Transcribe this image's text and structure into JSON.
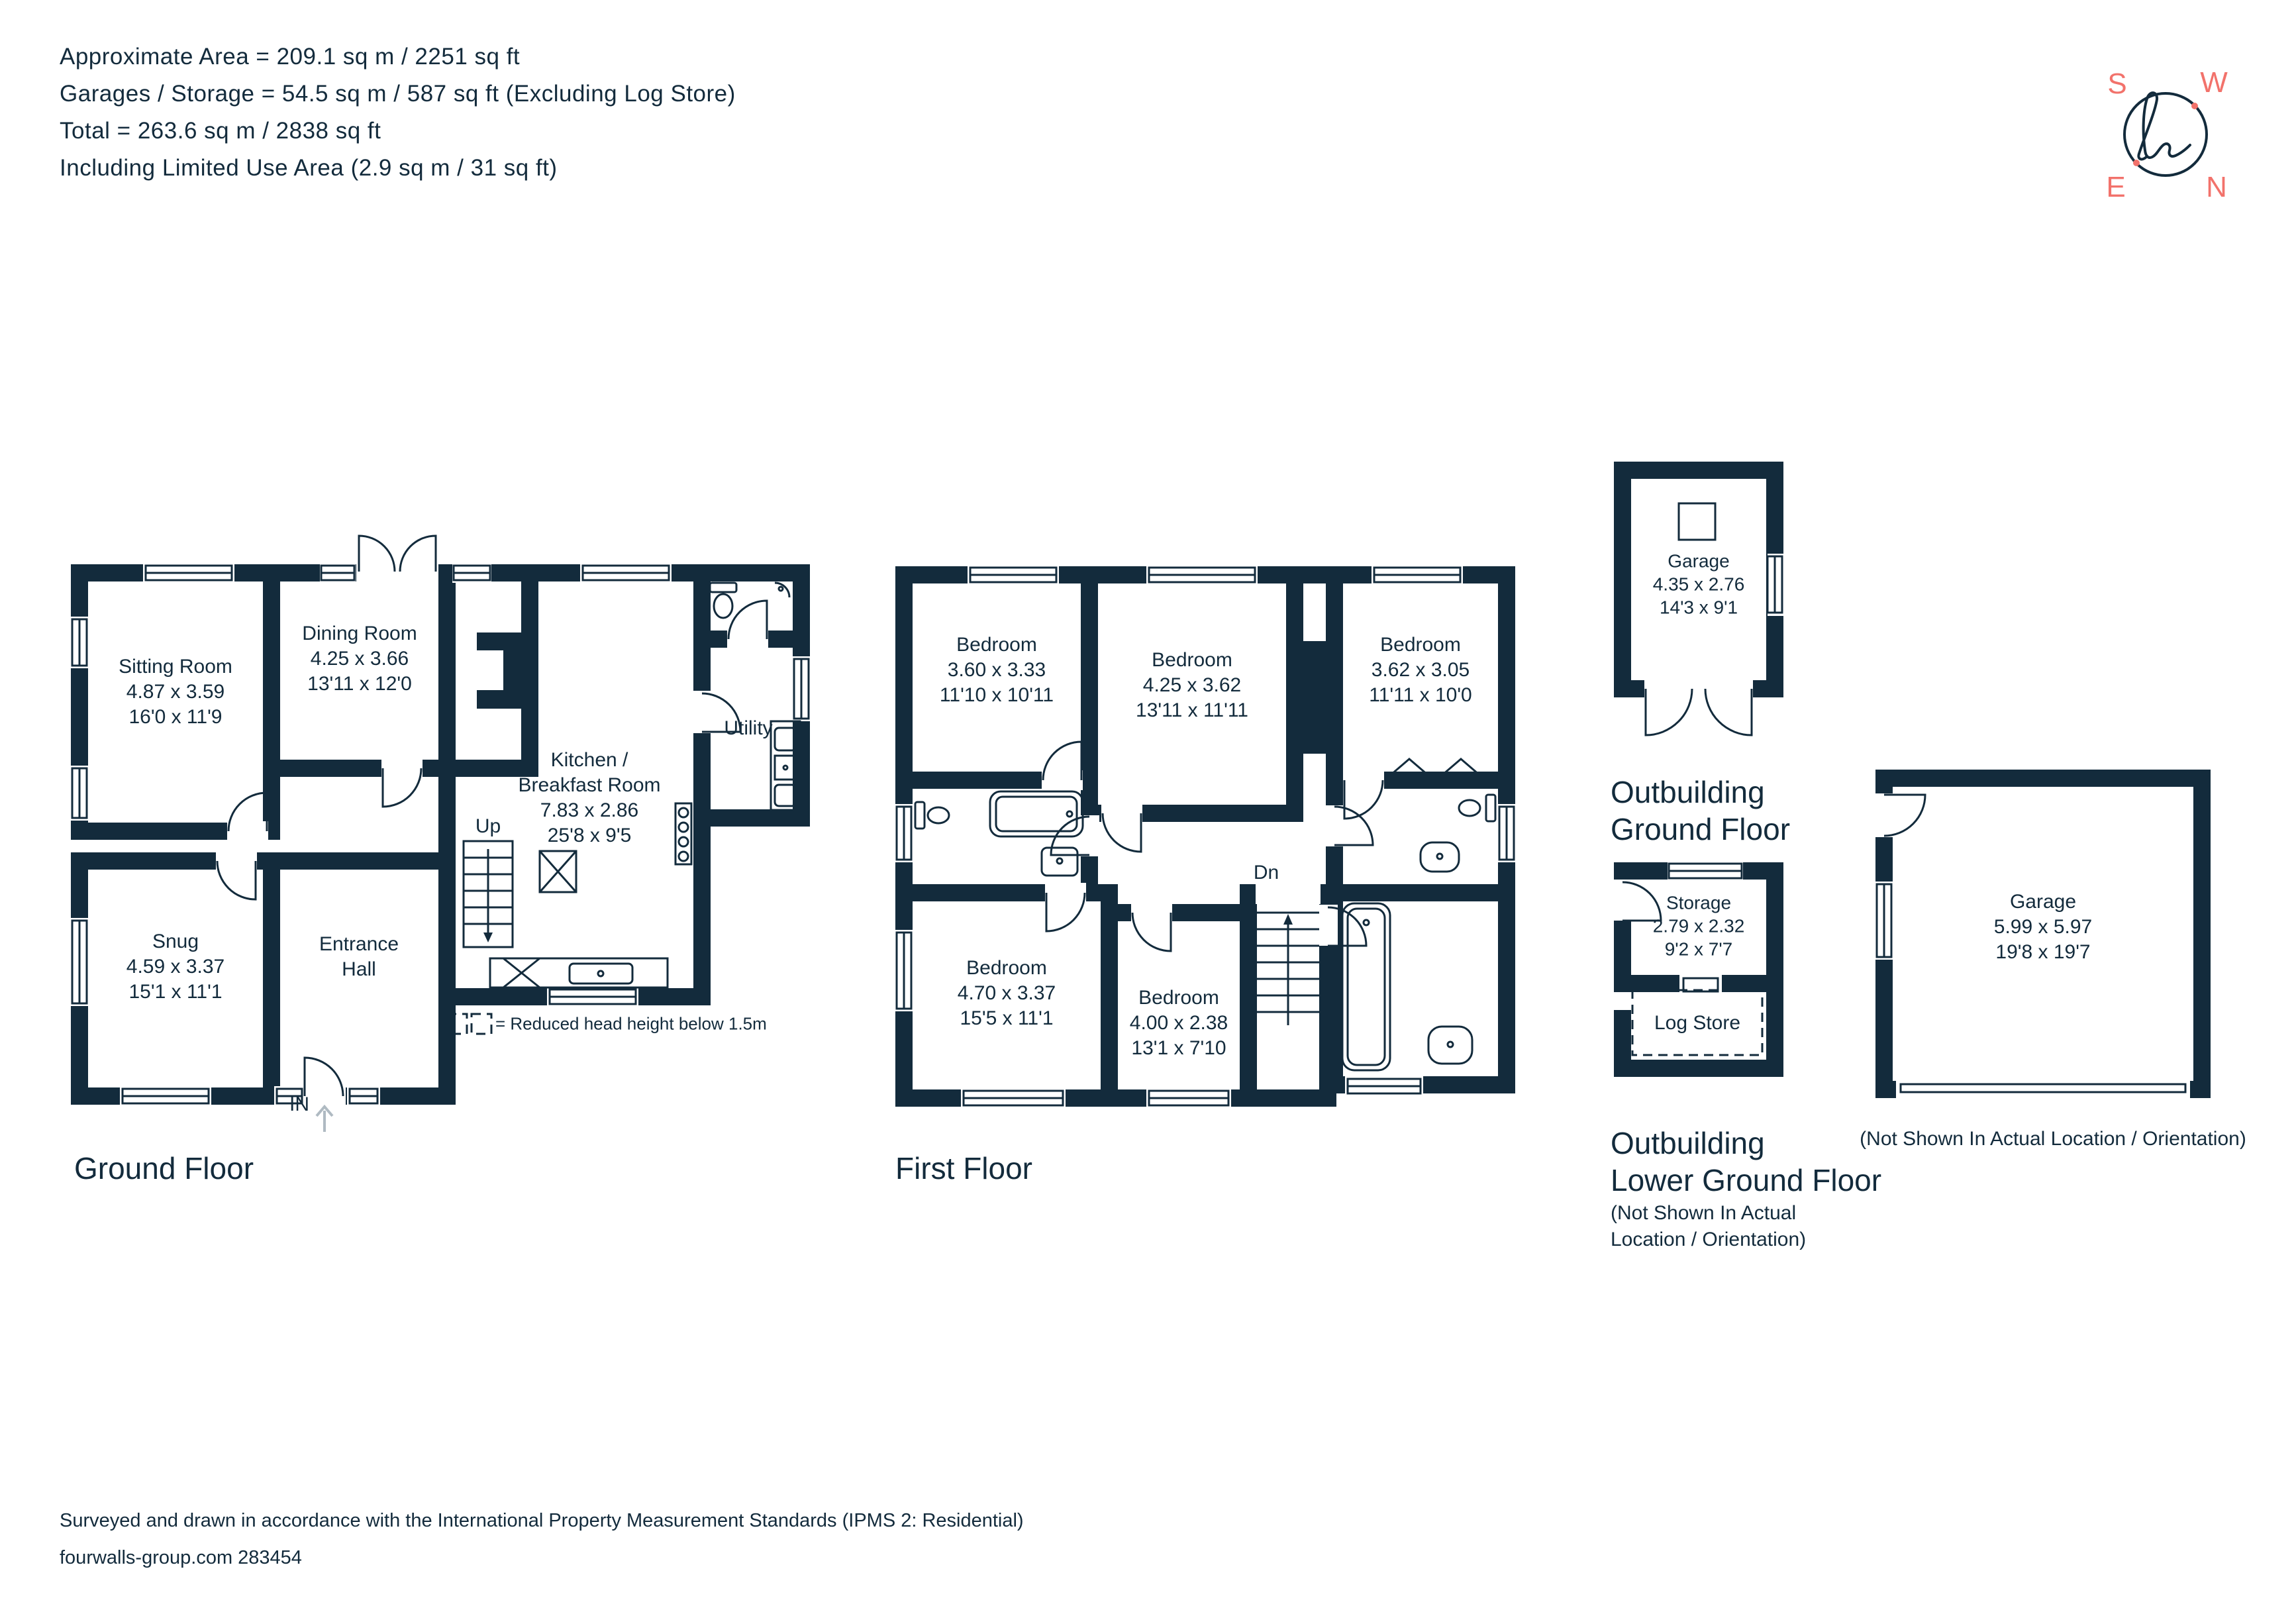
{
  "header": {
    "lines": [
      "Approximate Area = 209.1 sq m / 2251 sq ft",
      "Garages / Storage = 54.5 sq m / 587 sq ft (Excluding Log Store)",
      "Total = 263.6 sq m / 2838 sq ft",
      "Including Limited Use Area (2.9 sq m / 31 sq ft)"
    ]
  },
  "compass": {
    "s": "S",
    "w": "W",
    "e": "E",
    "n": "N"
  },
  "floors": {
    "ground": {
      "caption": "Ground Floor",
      "rooms": {
        "sitting": "Sitting Room\n4.87 x 3.59\n16'0 x 11'9",
        "dining": "Dining Room\n4.25 x 3.66\n13'11 x 12'0",
        "kitchen": "Kitchen /\nBreakfast Room\n7.83 x 2.86\n25'8 x 9'5",
        "utility": "Utility",
        "snug": "Snug\n4.59 x 3.37\n15'1 x 11'1",
        "hall": "Entrance\nHall"
      },
      "stairs": "Up",
      "entrance": "IN",
      "legend": "= Reduced head height below 1.5m"
    },
    "first": {
      "caption": "First Floor",
      "rooms": {
        "bed1": "Bedroom\n3.60 x 3.33\n11'10 x 10'11",
        "bed2": "Bedroom\n4.25 x 3.62\n13'11 x 11'11",
        "bed3": "Bedroom\n3.62 x 3.05\n11'11 x 10'0",
        "bed4": "Bedroom\n4.70 x 3.37\n15'5 x 11'1",
        "bed5": "Bedroom\n4.00 x 2.38\n13'1 x 7'10"
      },
      "stairs": "Dn"
    },
    "outbuilding_gf": {
      "caption": "Outbuilding\nGround Floor",
      "rooms": {
        "garage": "Garage\n4.35 x 2.76\n14'3 x 9'1"
      }
    },
    "outbuilding_lgf": {
      "caption": "Outbuilding\nLower Ground Floor",
      "note": "(Not Shown In Actual\nLocation / Orientation)",
      "rooms": {
        "storage": "Storage\n2.79 x 2.32\n9'2 x 7'7",
        "logstore": "Log Store"
      }
    },
    "garage_detached": {
      "rooms": {
        "garage": "Garage\n5.99 x 5.97\n19'8 x 19'7"
      },
      "note": "(Not Shown In Actual Location / Orientation)"
    }
  },
  "footer": {
    "line1": "Surveyed and drawn in accordance with the International Property Measurement Standards (IPMS 2: Residential)",
    "line2": "fourwalls-group.com 283454"
  },
  "colors": {
    "wall": "#132B3C",
    "accent": "#F2726B",
    "arrow": "#AFBAC2"
  }
}
